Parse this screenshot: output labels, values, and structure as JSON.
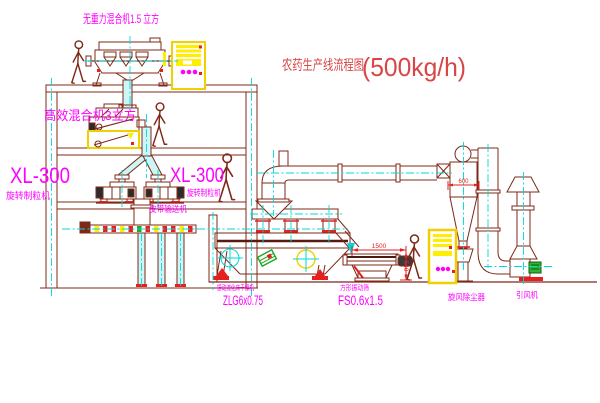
{
  "diagram": {
    "title": "农药生产线流程图",
    "capacity": "(500kg/h)"
  },
  "labels": {
    "gravity_free_mixer": "无重力混合机1.5 立方",
    "high_efficiency_mixer": "高效混合机3立方",
    "granulator_left_model": "XL-300",
    "granulator_left_name": "旋转制粒机",
    "granulator_mid_model": "XL-300",
    "granulator_mid_name": "旋转制粒机",
    "belt_conveyor": "皮带输送机",
    "dryer_name": "振动流化床干燥机",
    "dryer_model": "ZLG6x0.75",
    "sieve_name": "方形振动筛",
    "sieve_model": "FS0.6x1.5",
    "cyclone": "旋风除尘器",
    "fan": "引风机"
  },
  "dimensions": {
    "sieve_length": "1500",
    "sieve_height": "540",
    "cyclone_diameter": "600"
  },
  "colors": {
    "line": "#7e2817",
    "centerline": "#00d9d9",
    "label_magenta": "#ff00ff",
    "dimension_red": "#e62020",
    "title_red": "#d94545",
    "highlight_yellow": "#ffee00",
    "accent_green": "#1faa1f"
  }
}
